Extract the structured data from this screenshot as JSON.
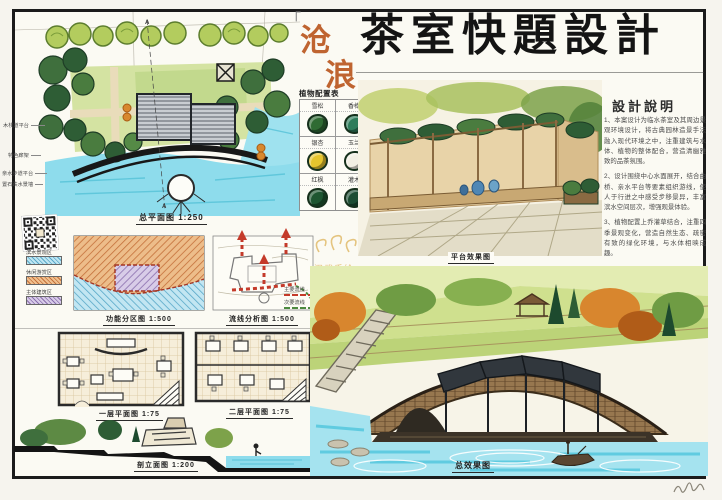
{
  "title": {
    "bracket": "「",
    "vertical_chars": [
      "沧",
      "浪",
      "亭"
    ],
    "main": "茶室快題設計"
  },
  "site_plan": {
    "caption": "总平面图 1:250",
    "section_mark": "A",
    "annotations": [
      "木栈道平台",
      "特色廊架",
      "亲水步道平台",
      "置石跌水景墙"
    ]
  },
  "plant_table": {
    "header": "植物配置表",
    "items": [
      {
        "name": "雪松",
        "color": "#2f6b33"
      },
      {
        "name": "香樟",
        "color": "#2e7d5b"
      },
      {
        "name": "银杏",
        "color": "#e6c52e"
      },
      {
        "name": "玉兰",
        "color": "#f2efe4"
      },
      {
        "name": "红枫",
        "color": "#1e5631"
      },
      {
        "name": "灌木",
        "color": "#1d4d33"
      }
    ]
  },
  "tea_terrace_view": {
    "caption": "平台效果图"
  },
  "design_notes": {
    "header": "設計說明",
    "items": [
      "1、本案设计为临水茶室及其周边景观环境设计，将古典园林造景手法融入现代环境之中，注重建筑与水体、植物的整体配合，营造清幽雅致的品茶氛围。",
      "2、设计围绕中心水面展开，结合曲桥、亲水平台等要素组织游线，使人于行进之中感受步移景异，丰富滨水空间层次，增强观景体验。",
      "3、植物配置上乔灌草结合，注重四季景观变化，营造自然生态、疏密有致的绿化环境，与水体相映成趣。"
    ]
  },
  "function_diagram": {
    "caption": "功能分区图 1:500",
    "legend": [
      {
        "label": "滨水景观区",
        "color": "#7cc4dc"
      },
      {
        "label": "休闲游赏区",
        "color": "#e09a5a"
      },
      {
        "label": "主体建筑区",
        "color": "#9f86c8"
      }
    ]
  },
  "circulation_diagram": {
    "caption": "流线分析图 1:500",
    "legend": [
      {
        "label": "主要流线",
        "color": "#c43a2a"
      },
      {
        "label": "次要流线",
        "color": "#4c8a3f"
      }
    ]
  },
  "floor_plans": {
    "first_caption": "一层平面图 1:75",
    "second_caption": "二层平面图 1:75"
  },
  "section_drawing": {
    "caption": "剖立面图 1:200"
  },
  "final_render": {
    "caption": "总效果图"
  },
  "watermark": {
    "text": "汉武手绘",
    "dots": "· · · · ·"
  }
}
